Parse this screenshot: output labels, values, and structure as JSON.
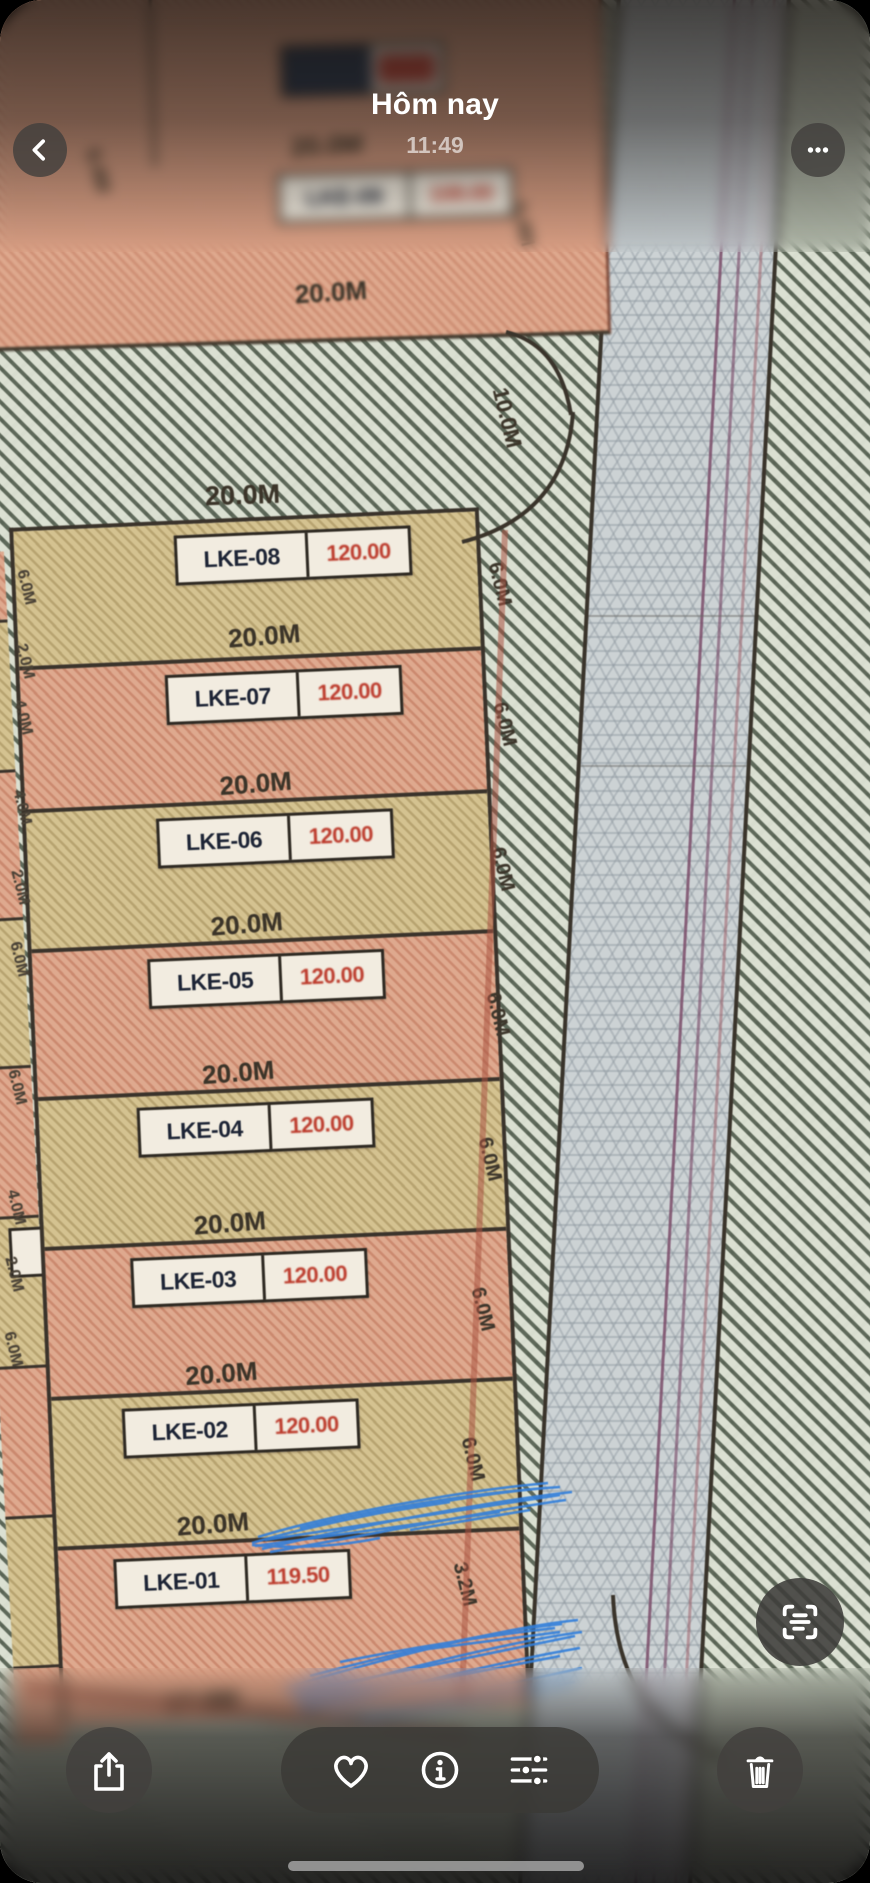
{
  "header": {
    "title": "Hôm nay",
    "time": "11:49"
  },
  "map": {
    "top_plot": {
      "id": "LKE-09",
      "area": "108.00",
      "dim_above": "20.0M",
      "dim_below": "20.0M",
      "left_dim": "6.4M",
      "right_dim": "5.4M"
    },
    "road_width_label": "10.0M",
    "block_top_dim": "20.0M",
    "plots": [
      {
        "id": "LKE-08",
        "area": "120.00",
        "bottom_dim": "20.0M"
      },
      {
        "id": "LKE-07",
        "area": "120.00",
        "bottom_dim": "20.0M"
      },
      {
        "id": "LKE-06",
        "area": "120.00",
        "bottom_dim": "20.0M"
      },
      {
        "id": "LKE-05",
        "area": "120.00",
        "bottom_dim": "20.0M"
      },
      {
        "id": "LKE-04",
        "area": "120.00",
        "bottom_dim": "20.0M"
      },
      {
        "id": "LKE-03",
        "area": "120.00",
        "bottom_dim": "20.0M"
      },
      {
        "id": "LKE-02",
        "area": "120.00",
        "bottom_dim": "20.0M"
      },
      {
        "id": "LKE-01",
        "area": "119.50",
        "bottom_dim": "17.0M"
      }
    ],
    "right_dims": [
      "6.0M",
      "6.0M",
      "6.0M",
      "6.0M",
      "6.0M",
      "6.0M",
      "6.0M",
      "3.2M"
    ],
    "left_dims": [
      "6.0M",
      "2.0M",
      "4.0M",
      "4.0M",
      "2.0M",
      "6.0M",
      "6.0M",
      "4.0M",
      "2.0M",
      "6.0M"
    ],
    "annotation_color": "#2f7fe0",
    "boundary_red": "#ad5240",
    "lane_line_purple": "#7d4e6b"
  },
  "toolbar": {
    "back": "back",
    "more": "more",
    "live_text": "detect-text",
    "share": "share",
    "favorite": "favorite",
    "info": "info",
    "adjust": "adjustments",
    "delete": "delete"
  }
}
